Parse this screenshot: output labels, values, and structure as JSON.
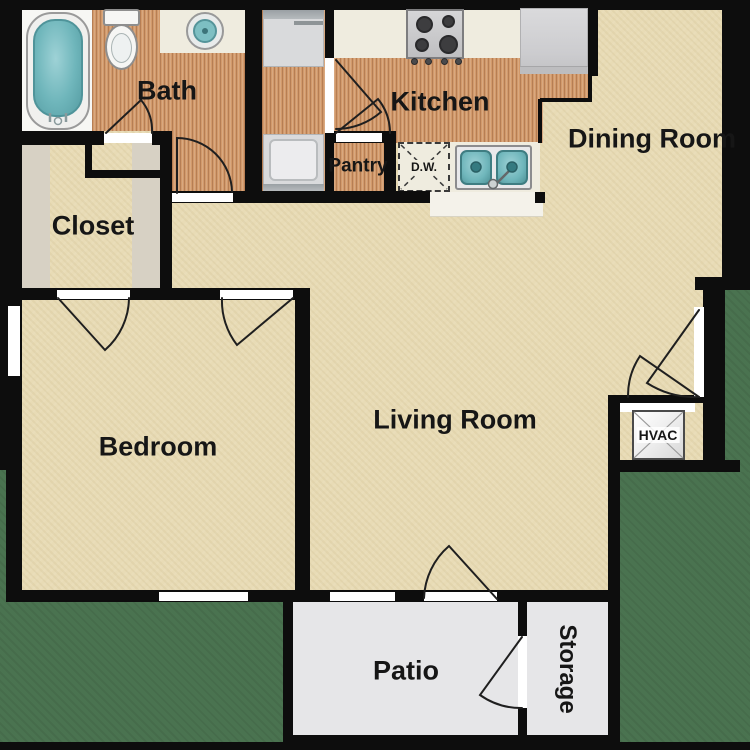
{
  "rooms": {
    "bath": {
      "label": "Bath"
    },
    "closet": {
      "label": "Closet"
    },
    "kitchen": {
      "label": "Kitchen"
    },
    "pantry": {
      "label": "Pantry"
    },
    "dining_room": {
      "label": "Dining Room"
    },
    "living_room": {
      "label": "Living Room"
    },
    "bedroom": {
      "label": "Bedroom"
    },
    "patio": {
      "label": "Patio"
    },
    "storage": {
      "label": "Storage"
    }
  },
  "equipment": {
    "hvac": {
      "label": "HVAC"
    },
    "dishwasher": {
      "label": "D.W."
    }
  },
  "fixtures": [
    "bathtub",
    "toilet",
    "bathroom-sink",
    "washer",
    "dryer",
    "stove",
    "refrigerator",
    "kitchen-sink",
    "dishwasher",
    "hvac-unit"
  ],
  "colors": {
    "wall": "#0d0d0d",
    "carpet": "#e8dbb5",
    "wood": "#d29a6b",
    "grass": "#4a7350",
    "counter": "#efecdf",
    "patio_floor": "#e6e6e8",
    "tub_water": "#6fb6bb",
    "closet_shelf": "#d7d1c4"
  }
}
